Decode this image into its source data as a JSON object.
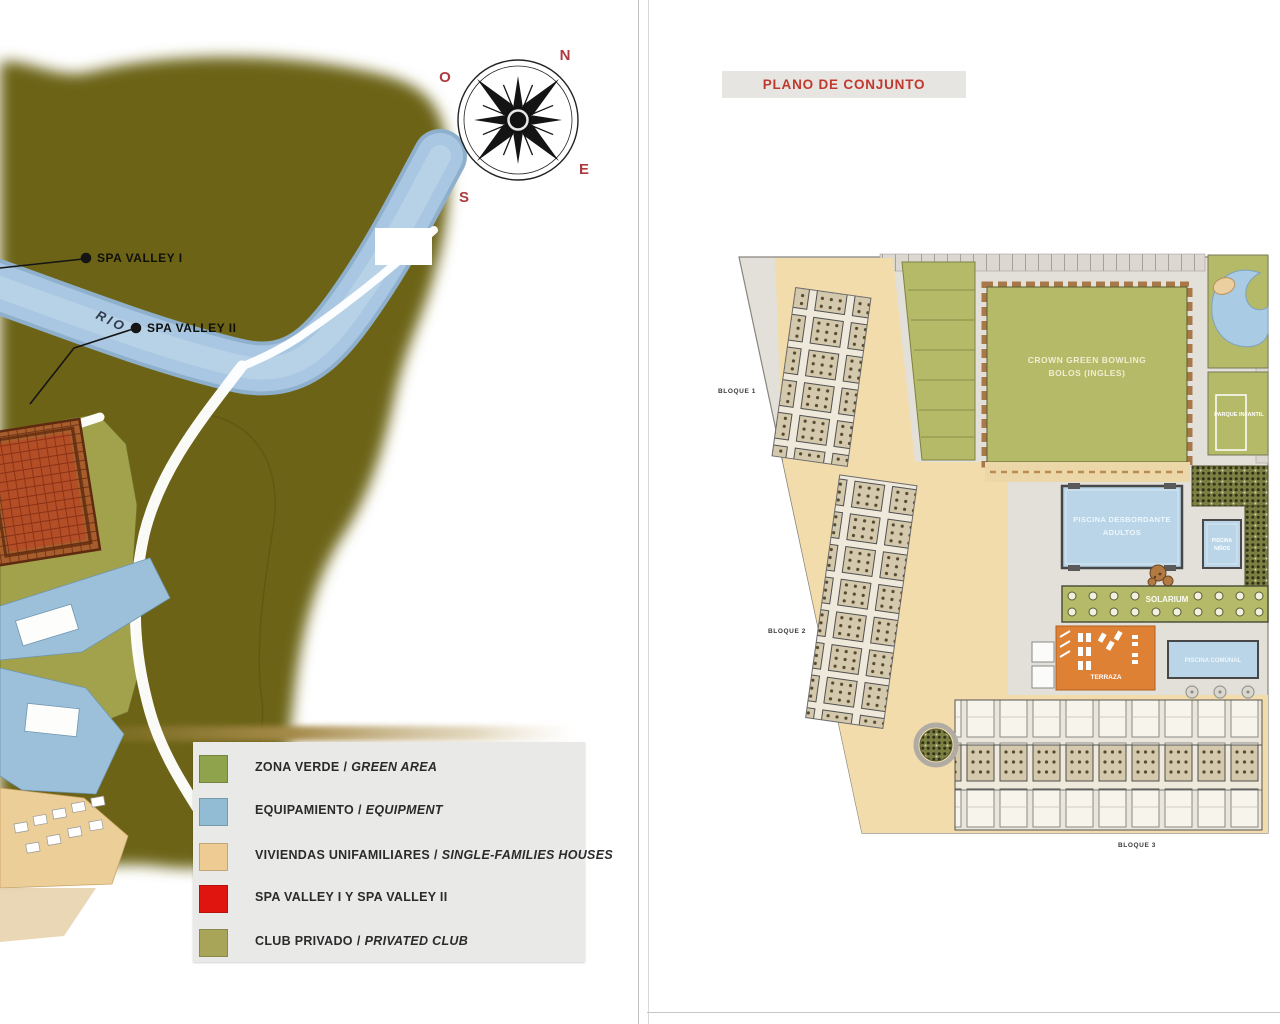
{
  "left_panel": {
    "map": {
      "rio_label": "RIO",
      "markers": [
        {
          "label": "SPA VALLEY I"
        },
        {
          "label": "SPA VALLEY II"
        }
      ]
    },
    "compass": {
      "n": "N",
      "s": "S",
      "e": "E",
      "o": "O"
    },
    "legend": {
      "items": [
        {
          "es": "ZONA VERDE",
          "sep": "/",
          "en": "GREEN AREA",
          "color": "#8fa34d"
        },
        {
          "es": "EQUIPAMIENTO",
          "sep": "/",
          "en": "EQUIPMENT",
          "color": "#92bcd3"
        },
        {
          "es": "VIVIENDAS UNIFAMILIARES",
          "sep": "/",
          "en": "SINGLE-FAMILIES HOUSES",
          "color": "#eecb92"
        },
        {
          "es": "SPA VALLEY I Y SPA VALLEY II",
          "sep": "",
          "en": "",
          "color": "#e01510"
        },
        {
          "es": "CLUB PRIVADO",
          "sep": "/",
          "en": "PRIVATED CLUB",
          "color": "#a8a559"
        }
      ]
    }
  },
  "right_panel": {
    "title": "PLANO DE CONJUNTO",
    "title_color": "#c0392f",
    "plan": {
      "blocks": [
        {
          "label": "BLOQUE 1"
        },
        {
          "label": "BLOQUE 2"
        },
        {
          "label": "BLOQUE 3"
        }
      ],
      "bowling": {
        "line1": "CROWN GREEN BOWLING",
        "line2": "BOLOS (INGLES)"
      },
      "adult_pool": {
        "line1": "PISCINA DESBORDANTE",
        "line2": "ADULTOS"
      },
      "kids_pool": {
        "line1": "PISCINA",
        "line2": "NIÑOS"
      },
      "communal_pool": {
        "label": "PISCINA COMUNAL"
      },
      "solarium": {
        "label": "SOLARIUM"
      },
      "terrace": {
        "label": "TERRAZA"
      },
      "park": {
        "label": "PARQUE INFANTIL"
      }
    }
  },
  "colors": {
    "terrain_dark": "#6c6314",
    "terrain_light": "#a2a24c",
    "river": "#a9c7e2",
    "plan_green": "#b4ba67",
    "pool_blue": "#b9d5e7",
    "orange_terrace": "#de8135",
    "sand": "#f2dcab",
    "compass_letters": "#ad3a3e"
  }
}
